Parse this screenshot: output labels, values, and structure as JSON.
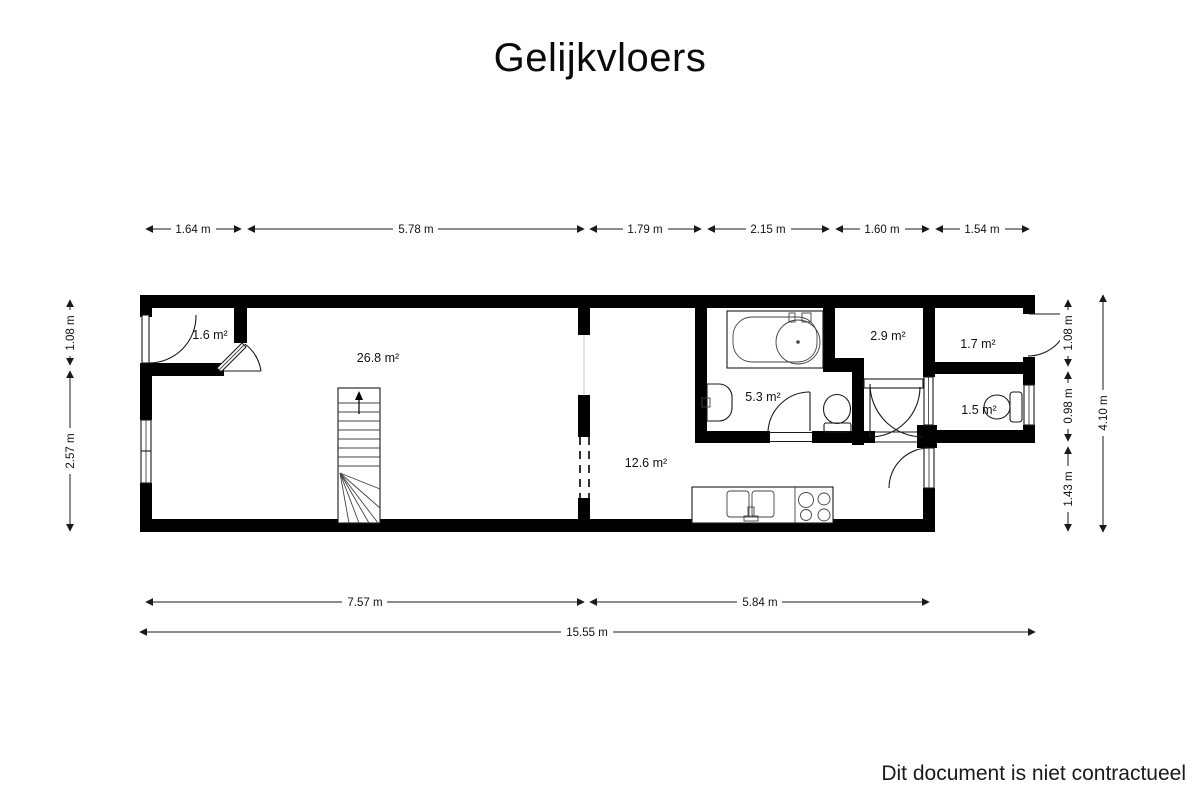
{
  "title": "Gelijkvloers",
  "footer": "Dit document is niet contractueel",
  "colors": {
    "wall": "#000000",
    "background": "#ffffff",
    "line": "#1a1a1a"
  },
  "floor_scale_unit": "m",
  "rooms": [
    {
      "id": "hall",
      "label": "1.6 m²"
    },
    {
      "id": "living",
      "label": "26.8 m²"
    },
    {
      "id": "kitchen",
      "label": "12.6 m²"
    },
    {
      "id": "bathroom",
      "label": "5.3 m²"
    },
    {
      "id": "storage",
      "label": "2.9 m²"
    },
    {
      "id": "rear-hall",
      "label": "1.7 m²"
    },
    {
      "id": "wc",
      "label": "1.5 m²"
    }
  ],
  "dimensions": {
    "top": [
      "1.64 m",
      "5.78 m",
      "1.79 m",
      "2.15 m",
      "1.60 m",
      "1.54 m"
    ],
    "left": [
      "1.08 m",
      "2.57 m"
    ],
    "right": [
      "1.08 m",
      "0.98 m",
      "1.43 m"
    ],
    "right_total": "4.10 m",
    "bottom": [
      "7.57 m",
      "5.84 m"
    ],
    "bottom_total": "15.55 m"
  }
}
